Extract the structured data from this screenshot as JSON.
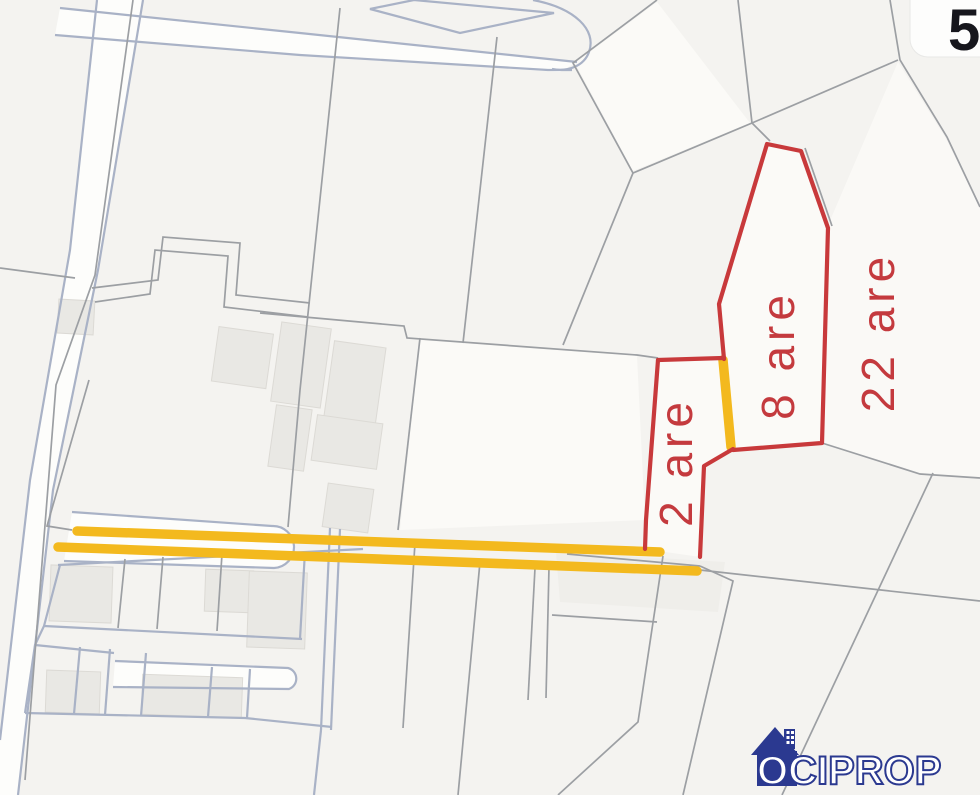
{
  "map": {
    "type": "cadastral-parcel-map",
    "background_color": "#f4f3f0",
    "line_colors": {
      "parcel_blue": "#a9b2c6",
      "parcel_gray": "#9c9fa3",
      "highlight_red": "#c8393b",
      "road_highlight_yellow": "#f3b91e"
    },
    "building_fill": "#e9e8e4",
    "parcels": [
      {
        "id": "parcel-2-are",
        "label": "2 are",
        "outline": "red"
      },
      {
        "id": "parcel-8-are",
        "label": "8 are",
        "outline": "red"
      },
      {
        "id": "parcel-22-are",
        "label": "22 are",
        "outline": "red-left-edge"
      }
    ],
    "label_color": "#c43a3e",
    "road_highlight": {
      "color": "#f3b91e",
      "segment_count": 3
    },
    "corner_marker": {
      "partial_text": "5"
    }
  },
  "branding": {
    "logo_text": "OCIPROP",
    "logo_color": "#2b3990",
    "icon": "house-icon"
  }
}
